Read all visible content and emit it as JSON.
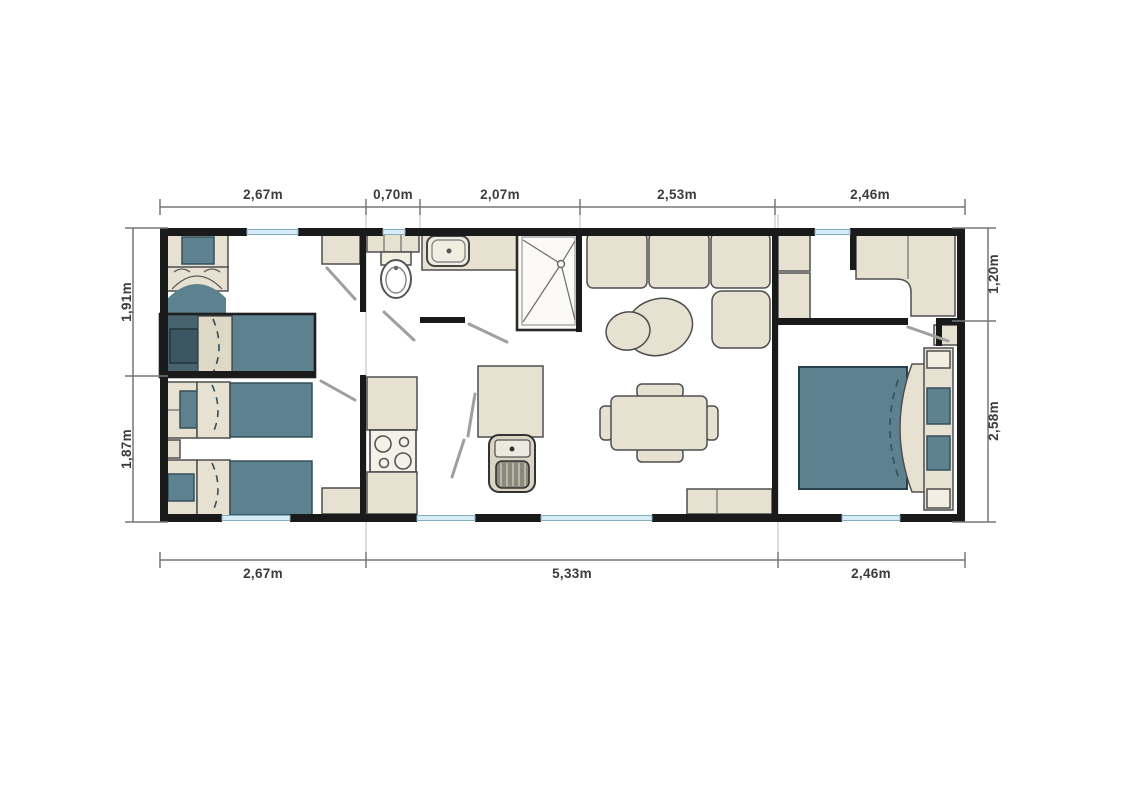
{
  "app": {
    "type": "mobile-home-floor-plan"
  },
  "dimensions": {
    "top": [
      "2,67m",
      "0,70m",
      "2,07m",
      "2,53m",
      "2,46m"
    ],
    "bottom": [
      "2,67m",
      "5,33m",
      "2,46m"
    ],
    "left": [
      "1,91m",
      "1,87m"
    ],
    "right": [
      "1,20m",
      "2,58m"
    ]
  },
  "colors": {
    "background": "#ffffff",
    "wall": "#1a1a1a",
    "furniture": "#e7e1d1",
    "upholstery": "#5d818e",
    "upholstery_dark": "#47636e",
    "window": "#d6edf8",
    "dimension_text": "#3c3c3c",
    "outline": "#4f4f4f",
    "door_swing": "#9f9f9f"
  },
  "rooms": [
    "twin-bedroom-top-left",
    "twin-bedroom-bottom-left",
    "wc",
    "bathroom-with-shower",
    "kitchen",
    "living-dining-room",
    "entry-wardrobe-area",
    "master-bedroom"
  ],
  "furniture": [
    "single-bed",
    "single-bed",
    "single-bed",
    "single-bed",
    "double-bed",
    "wardrobe",
    "toilet",
    "washbasin",
    "shower-cabin",
    "hob",
    "kitchen-island-sink",
    "sofa",
    "poufs",
    "dining-table",
    "chairs",
    "nightstands",
    "bench"
  ]
}
